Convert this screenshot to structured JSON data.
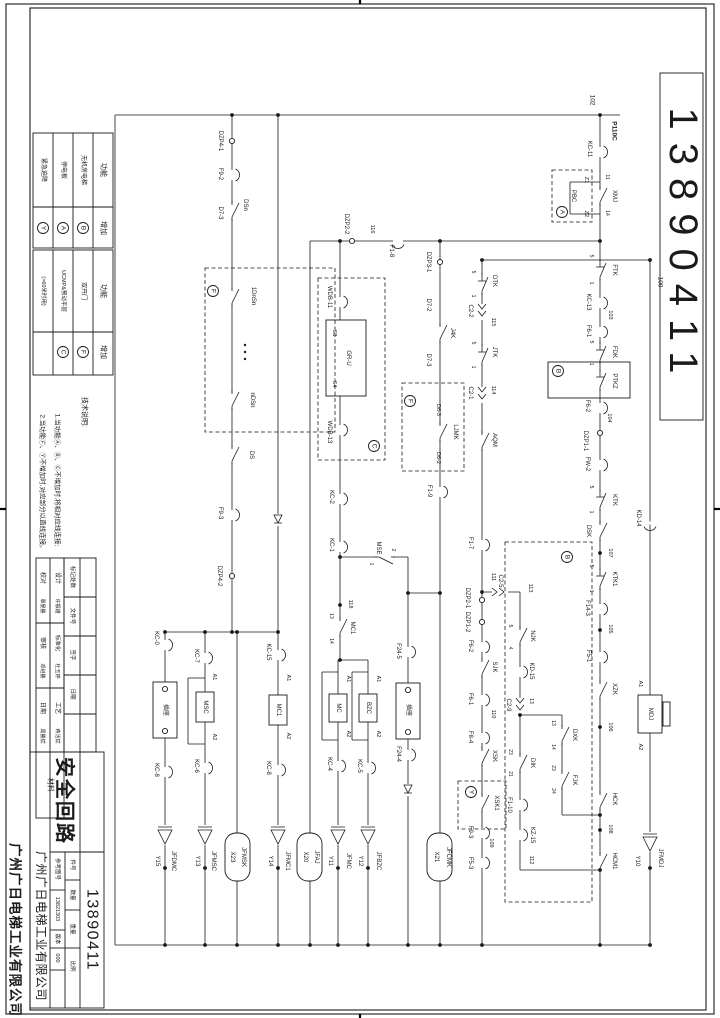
{
  "sheet": {
    "drawing_number": "13890411",
    "drawing_title": "安全回路",
    "company": "广州广日电梯工业有限公司",
    "reference_drawing_number": "13821303",
    "version": "000",
    "field_labels": {
      "reference": "参考图号",
      "part_no": "件号",
      "quantity": "数量",
      "weight": "重量",
      "scale": "比例",
      "version": "版本",
      "material": "材料"
    }
  },
  "function_tables": [
    {
      "headers": [
        "功能",
        "增加"
      ],
      "rows": [
        [
          "无机房电梯",
          "B"
        ],
        [
          "停电板",
          "A"
        ],
        [
          "紧急迫降",
          "Y"
        ]
      ]
    },
    {
      "headers": [
        "功能",
        "增加"
      ],
      "rows": [
        [
          "双开门",
          "F"
        ],
        [
          "UCMP&预动平层",
          "C"
        ],
        [
          "(>60米时用)",
          ""
        ]
      ]
    }
  ],
  "notes": {
    "title": "技术说明:",
    "lines": [
      "1.当功能Ⓐ、Ⓑ、Ⓒ不增加时,将相对应线连接;",
      "2.当功能Ⓕ、Ⓨ不增加时,对应部分以直线连接。"
    ]
  },
  "signatures": [
    {
      "role": "设计",
      "name": "许振雄"
    },
    {
      "role": "校对",
      "name": "覃晏勝"
    },
    {
      "role": "标准化",
      "name": "杜玉婷"
    },
    {
      "role": "审核",
      "name": "邓继勝"
    },
    {
      "role": "工艺",
      "name": "蒋活斌"
    },
    {
      "role": "日期",
      "name": "周勝斌"
    }
  ],
  "revision_table": {
    "headers": [
      "标记处数",
      "文件号",
      "签字",
      "日期"
    ]
  },
  "buses": {
    "top": "102",
    "feed": "P110C",
    "right": "100"
  },
  "labels": [
    {
      "t": "13890411",
      "x": 683,
      "y": 247,
      "s": 40,
      "ls": 13,
      "n": "drawing-number-top"
    },
    {
      "t": "功能",
      "x": 103,
      "y": 170,
      "s": 7
    },
    {
      "t": "增加",
      "x": 103,
      "y": 228,
      "s": 7
    },
    {
      "t": "无机房电梯",
      "x": 83,
      "y": 170,
      "s": 6
    },
    {
      "t": "停电板",
      "x": 63,
      "y": 170,
      "s": 6
    },
    {
      "t": "紧急迫降",
      "x": 43,
      "y": 170,
      "s": 6
    },
    {
      "t": "功能",
      "x": 103,
      "y": 291,
      "s": 7
    },
    {
      "t": "增加",
      "x": 103,
      "y": 352,
      "s": 7
    },
    {
      "t": "双开门",
      "x": 83,
      "y": 291,
      "s": 6
    },
    {
      "t": "UCMP&预动平层",
      "x": 63,
      "y": 291,
      "s": 5.5
    },
    {
      "t": "(>60米时用)",
      "x": 43,
      "y": 291,
      "s": 5.5
    },
    {
      "t": "技术说明:",
      "x": 84,
      "y": 412,
      "s": 7,
      "n": "notes-title"
    },
    {
      "t": "1.当功能Ⓐ、Ⓑ、Ⓒ不增加时,将相对应线连接;",
      "x": 57,
      "y": 480,
      "s": 6.5,
      "n": "note-line"
    },
    {
      "t": "2.当功能Ⓕ、Ⓨ不增加时,对应部分以直线连接。",
      "x": 42,
      "y": 483,
      "s": 6.5,
      "n": "note-line"
    },
    {
      "t": "校对",
      "x": 42,
      "y": 578,
      "s": 6
    },
    {
      "t": "覃晏勝",
      "x": 42,
      "y": 606,
      "s": 5
    },
    {
      "t": "设计",
      "x": 57,
      "y": 578,
      "s": 6
    },
    {
      "t": "许振雄",
      "x": 57,
      "y": 606,
      "s": 5
    },
    {
      "t": "审核",
      "x": 42,
      "y": 643,
      "s": 6
    },
    {
      "t": "邓继勝",
      "x": 42,
      "y": 671,
      "s": 5
    },
    {
      "t": "标准化",
      "x": 57,
      "y": 643,
      "s": 5.5
    },
    {
      "t": "杜玉婷",
      "x": 57,
      "y": 671,
      "s": 5
    },
    {
      "t": "日期",
      "x": 42,
      "y": 708,
      "s": 6
    },
    {
      "t": "周勝斌",
      "x": 42,
      "y": 736,
      "s": 5
    },
    {
      "t": "工艺",
      "x": 57,
      "y": 708,
      "s": 6
    },
    {
      "t": "蒋活斌",
      "x": 57,
      "y": 736,
      "s": 5
    },
    {
      "t": "材料",
      "x": 50,
      "y": 785,
      "s": 7
    },
    {
      "t": "标记处数",
      "x": 72,
      "y": 577,
      "s": 5.5
    },
    {
      "t": "文件号",
      "x": 72,
      "y": 616,
      "s": 5.5
    },
    {
      "t": "签字",
      "x": 72,
      "y": 655,
      "s": 5.5
    },
    {
      "t": "日期",
      "x": 72,
      "y": 694,
      "s": 5.5
    },
    {
      "t": "安全回路",
      "x": 64,
      "y": 801,
      "s": 20,
      "b": 1,
      "ls": 2,
      "n": "drawing-title"
    },
    {
      "t": "广州广日电梯工业有限公司",
      "x": 41,
      "y": 926,
      "s": 12,
      "ls": 0.5,
      "n": "company-name-small"
    },
    {
      "t": "广州广日电梯工业有限公司",
      "x": 15,
      "y": 930,
      "s": 13.5,
      "b": 1,
      "ls": 1,
      "n": "company-name-large"
    },
    {
      "t": "参考图号",
      "x": 57,
      "y": 869,
      "s": 5.5
    },
    {
      "t": "13821303",
      "x": 57,
      "y": 909,
      "s": 5.5,
      "n": "reference-number"
    },
    {
      "t": "版本",
      "x": 57,
      "y": 939,
      "s": 5.5
    },
    {
      "t": "000",
      "x": 57,
      "y": 958,
      "s": 5.5,
      "n": "version-value"
    },
    {
      "t": "件号",
      "x": 72,
      "y": 865,
      "s": 5.5
    },
    {
      "t": "数量",
      "x": 72,
      "y": 895,
      "s": 5.5
    },
    {
      "t": "重量",
      "x": 72,
      "y": 929,
      "s": 5.5
    },
    {
      "t": "比例",
      "x": 72,
      "y": 966,
      "s": 5.5
    },
    {
      "t": "13890411",
      "x": 92,
      "y": 930,
      "s": 16,
      "ls": 1.5,
      "n": "drawing-number-block"
    },
    {
      "t": "102",
      "x": 592,
      "y": 100,
      "s": 6.5,
      "n": "bus-label"
    },
    {
      "t": "P110C",
      "x": 614,
      "y": 131,
      "s": 6.5,
      "b": 1,
      "n": "bus-label"
    },
    {
      "t": "100",
      "x": 660,
      "y": 282,
      "s": 6.5,
      "n": "bus-label"
    },
    {
      "t": "KC-11",
      "x": 589,
      "y": 149
    },
    {
      "t": "XMJ",
      "x": 614,
      "y": 196
    },
    {
      "t": "11",
      "x": 607,
      "y": 177,
      "s": 5
    },
    {
      "t": "14",
      "x": 607,
      "y": 213,
      "s": 5
    },
    {
      "t": "Z1",
      "x": 586,
      "y": 180,
      "s": 5.5
    },
    {
      "t": "PBC",
      "x": 573,
      "y": 196
    },
    {
      "t": "Z2",
      "x": 586,
      "y": 214,
      "s": 5.5
    },
    {
      "t": "FTK",
      "x": 614,
      "y": 270
    },
    {
      "t": "5",
      "x": 591,
      "y": 256,
      "s": 5
    },
    {
      "t": "1",
      "x": 591,
      "y": 283,
      "s": 5
    },
    {
      "t": "KC-13",
      "x": 588,
      "y": 302
    },
    {
      "t": "103",
      "x": 610,
      "y": 315,
      "s": 5.5
    },
    {
      "t": "F6-1",
      "x": 588,
      "y": 331
    },
    {
      "t": "FDK",
      "x": 614,
      "y": 352
    },
    {
      "t": "5",
      "x": 591,
      "y": 342,
      "s": 5
    },
    {
      "t": "1",
      "x": 591,
      "y": 364,
      "s": 5
    },
    {
      "t": "PTKZ",
      "x": 614,
      "y": 381
    },
    {
      "t": "F6-2",
      "x": 587,
      "y": 406
    },
    {
      "t": "104",
      "x": 609,
      "y": 418,
      "s": 5.5
    },
    {
      "t": "DZP1-1",
      "x": 585,
      "y": 441
    },
    {
      "t": "FW-2",
      "x": 587,
      "y": 464
    },
    {
      "t": "KTK",
      "x": 614,
      "y": 500
    },
    {
      "t": "5",
      "x": 591,
      "y": 487,
      "s": 5
    },
    {
      "t": "1",
      "x": 591,
      "y": 512,
      "s": 5
    },
    {
      "t": "DSK",
      "x": 588,
      "y": 531
    },
    {
      "t": "107",
      "x": 610,
      "y": 553,
      "s": 5.5
    },
    {
      "t": "KTK1",
      "x": 614,
      "y": 579
    },
    {
      "t": "5",
      "x": 591,
      "y": 566,
      "s": 5
    },
    {
      "t": "1",
      "x": 591,
      "y": 591,
      "s": 5
    },
    {
      "t": "F14-3",
      "x": 587,
      "y": 608
    },
    {
      "t": "105",
      "x": 610,
      "y": 629,
      "s": 5.5
    },
    {
      "t": "F5-1",
      "x": 588,
      "y": 656
    },
    {
      "t": "XZK",
      "x": 614,
      "y": 689
    },
    {
      "t": "106",
      "x": 610,
      "y": 727,
      "s": 5.5
    },
    {
      "t": "HCK",
      "x": 614,
      "y": 799
    },
    {
      "t": "108",
      "x": 610,
      "y": 829,
      "s": 5.5
    },
    {
      "t": "HCM1",
      "x": 614,
      "y": 861
    },
    {
      "t": "KD-14",
      "x": 638,
      "y": 518
    },
    {
      "t": "A1",
      "x": 640,
      "y": 684,
      "s": 5.5
    },
    {
      "t": "MDJ",
      "x": 650,
      "y": 714
    },
    {
      "t": "A2",
      "x": 640,
      "y": 747,
      "s": 5.5
    },
    {
      "t": "Y10",
      "x": 637,
      "y": 861
    },
    {
      "t": "JFMDJ",
      "x": 660,
      "y": 858
    },
    {
      "t": "DZP4-1",
      "x": 220,
      "y": 141
    },
    {
      "t": "F9-2",
      "x": 220,
      "y": 174
    },
    {
      "t": "DSn",
      "x": 245,
      "y": 205
    },
    {
      "t": "D7-3",
      "x": 220,
      "y": 213
    },
    {
      "t": "1DnSn",
      "x": 253,
      "y": 296
    },
    {
      "t": "nDSn",
      "x": 252,
      "y": 400
    },
    {
      "t": "DS",
      "x": 251,
      "y": 455
    },
    {
      "t": "F9-3",
      "x": 220,
      "y": 513
    },
    {
      "t": "DZP4-2",
      "x": 219,
      "y": 576
    },
    {
      "t": "KC-0",
      "x": 156,
      "y": 638
    },
    {
      "t": "KC-8",
      "x": 156,
      "y": 770
    },
    {
      "t": "插座",
      "x": 165,
      "y": 710,
      "s": 6
    },
    {
      "t": "Y15",
      "x": 157,
      "y": 861
    },
    {
      "t": "JFDMC",
      "x": 173,
      "y": 861
    },
    {
      "t": "KC-7",
      "x": 196,
      "y": 656
    },
    {
      "t": "A1",
      "x": 214,
      "y": 677,
      "s": 5.5
    },
    {
      "t": "MSC",
      "x": 205,
      "y": 707
    },
    {
      "t": "A2",
      "x": 214,
      "y": 737,
      "s": 5.5
    },
    {
      "t": "KC-6",
      "x": 196,
      "y": 766
    },
    {
      "t": "Y13",
      "x": 197,
      "y": 861
    },
    {
      "t": "JFMSC",
      "x": 213,
      "y": 861
    },
    {
      "t": "X23",
      "x": 232,
      "y": 857
    },
    {
      "t": "JFMSK",
      "x": 243,
      "y": 857
    },
    {
      "t": "KC-15",
      "x": 268,
      "y": 652
    },
    {
      "t": "A1",
      "x": 288,
      "y": 678,
      "s": 5.5
    },
    {
      "t": "MC1",
      "x": 278,
      "y": 710
    },
    {
      "t": "A2",
      "x": 288,
      "y": 736,
      "s": 5.5
    },
    {
      "t": "KC-8",
      "x": 268,
      "y": 768
    },
    {
      "t": "Y14",
      "x": 270,
      "y": 861
    },
    {
      "t": "JFMC1",
      "x": 287,
      "y": 861
    },
    {
      "t": "X20",
      "x": 305,
      "y": 857
    },
    {
      "t": "JFAJ",
      "x": 316,
      "y": 857
    },
    {
      "t": "DZP2-2",
      "x": 346,
      "y": 224
    },
    {
      "t": "116",
      "x": 372,
      "y": 229,
      "s": 5.5
    },
    {
      "t": "F1-8",
      "x": 391,
      "y": 251
    },
    {
      "t": "WDB-11",
      "x": 329,
      "y": 297
    },
    {
      "t": "S3",
      "x": 334,
      "y": 333,
      "s": 5.5
    },
    {
      "t": "GR-U",
      "x": 348,
      "y": 358
    },
    {
      "t": "S4",
      "x": 334,
      "y": 384,
      "s": 5.5
    },
    {
      "t": "WDB-13",
      "x": 329,
      "y": 432
    },
    {
      "t": "KC-2",
      "x": 331,
      "y": 497
    },
    {
      "t": "KC-1",
      "x": 331,
      "y": 545
    },
    {
      "t": "MSE",
      "x": 378,
      "y": 548
    },
    {
      "t": "2",
      "x": 393,
      "y": 550,
      "s": 5
    },
    {
      "t": "1",
      "x": 371,
      "y": 564,
      "s": 5
    },
    {
      "t": "118",
      "x": 350,
      "y": 604,
      "s": 5.5
    },
    {
      "t": "13",
      "x": 331,
      "y": 616,
      "s": 5
    },
    {
      "t": "MC1",
      "x": 352,
      "y": 628
    },
    {
      "t": "14",
      "x": 331,
      "y": 641,
      "s": 5
    },
    {
      "t": "A1",
      "x": 348,
      "y": 679,
      "s": 5.5
    },
    {
      "t": "MC",
      "x": 338,
      "y": 708
    },
    {
      "t": "A2",
      "x": 348,
      "y": 734,
      "s": 5.5
    },
    {
      "t": "KC-4",
      "x": 329,
      "y": 764
    },
    {
      "t": "Y11",
      "x": 330,
      "y": 861
    },
    {
      "t": "JFMC",
      "x": 348,
      "y": 861
    },
    {
      "t": "A1",
      "x": 378,
      "y": 679,
      "s": 5.5
    },
    {
      "t": "BZC",
      "x": 368,
      "y": 708
    },
    {
      "t": "A2",
      "x": 378,
      "y": 734,
      "s": 5.5
    },
    {
      "t": "KC-5",
      "x": 359,
      "y": 766
    },
    {
      "t": "Y12",
      "x": 360,
      "y": 861
    },
    {
      "t": "JFBZC",
      "x": 378,
      "y": 861
    },
    {
      "t": "F24-5",
      "x": 398,
      "y": 651
    },
    {
      "t": "插座",
      "x": 408,
      "y": 710,
      "s": 6
    },
    {
      "t": "F24-4",
      "x": 398,
      "y": 754
    },
    {
      "t": "DZP3-1",
      "x": 428,
      "y": 262
    },
    {
      "t": "D7-2",
      "x": 428,
      "y": 305
    },
    {
      "t": "J4K",
      "x": 452,
      "y": 333
    },
    {
      "t": "D7-3",
      "x": 428,
      "y": 360
    },
    {
      "t": "D6-3",
      "x": 438,
      "y": 410,
      "s": 5.5
    },
    {
      "t": "LJMK",
      "x": 455,
      "y": 432
    },
    {
      "t": "D6-2",
      "x": 438,
      "y": 458,
      "s": 5.5
    },
    {
      "t": "F1-9",
      "x": 429,
      "y": 491
    },
    {
      "t": "X21",
      "x": 436,
      "y": 857
    },
    {
      "t": "JFCMK",
      "x": 448,
      "y": 857
    },
    {
      "t": "DTK",
      "x": 494,
      "y": 281
    },
    {
      "t": "5",
      "x": 473,
      "y": 272,
      "s": 5
    },
    {
      "t": "1",
      "x": 473,
      "y": 296,
      "s": 5
    },
    {
      "t": "C2-2",
      "x": 470,
      "y": 311
    },
    {
      "t": "115",
      "x": 493,
      "y": 322,
      "s": 5.5
    },
    {
      "t": "JTK",
      "x": 494,
      "y": 352
    },
    {
      "t": "5",
      "x": 473,
      "y": 343,
      "s": 5
    },
    {
      "t": "1",
      "x": 473,
      "y": 367,
      "s": 5
    },
    {
      "t": "C2-1",
      "x": 470,
      "y": 393
    },
    {
      "t": "114",
      "x": 493,
      "y": 390,
      "s": 5.5
    },
    {
      "t": "AQM",
      "x": 494,
      "y": 440
    },
    {
      "t": "F1-7",
      "x": 470,
      "y": 543
    },
    {
      "t": "111",
      "x": 493,
      "y": 577,
      "s": 5.5
    },
    {
      "t": "DZP2-1",
      "x": 467,
      "y": 598
    },
    {
      "t": "DZP1-2",
      "x": 467,
      "y": 622
    },
    {
      "t": "F6-2",
      "x": 470,
      "y": 646
    },
    {
      "t": "SJK",
      "x": 494,
      "y": 667
    },
    {
      "t": "F6-1",
      "x": 470,
      "y": 699
    },
    {
      "t": "110",
      "x": 493,
      "y": 714,
      "s": 5.5
    },
    {
      "t": "F8-4",
      "x": 470,
      "y": 737
    },
    {
      "t": "XSK",
      "x": 494,
      "y": 756
    },
    {
      "t": "XSK1",
      "x": 496,
      "y": 803
    },
    {
      "t": "F9-3",
      "x": 470,
      "y": 832
    },
    {
      "t": "109",
      "x": 491,
      "y": 843,
      "s": 5.5
    },
    {
      "t": "F5-3",
      "x": 470,
      "y": 863
    },
    {
      "t": "C2-5",
      "x": 500,
      "y": 581
    },
    {
      "t": "113",
      "x": 530,
      "y": 588,
      "s": 5.5
    },
    {
      "t": "5",
      "x": 510,
      "y": 626,
      "s": 5
    },
    {
      "t": "NJK",
      "x": 532,
      "y": 636
    },
    {
      "t": "4",
      "x": 510,
      "y": 648,
      "s": 5
    },
    {
      "t": "KD-15",
      "x": 531,
      "y": 671
    },
    {
      "t": "C2-9",
      "x": 508,
      "y": 705
    },
    {
      "t": "13",
      "x": 531,
      "y": 701,
      "s": 5
    },
    {
      "t": "23",
      "x": 510,
      "y": 752,
      "s": 5
    },
    {
      "t": "DIK",
      "x": 532,
      "y": 763
    },
    {
      "t": "21",
      "x": 510,
      "y": 774,
      "s": 5
    },
    {
      "t": "F1-10",
      "x": 509,
      "y": 805
    },
    {
      "t": "KZ-15",
      "x": 532,
      "y": 835
    },
    {
      "t": "112",
      "x": 531,
      "y": 860,
      "s": 5.5
    },
    {
      "t": "13",
      "x": 553,
      "y": 723,
      "s": 5
    },
    {
      "t": "DXK",
      "x": 574,
      "y": 735
    },
    {
      "t": "14",
      "x": 553,
      "y": 747,
      "s": 5
    },
    {
      "t": "23",
      "x": 553,
      "y": 768,
      "s": 5
    },
    {
      "t": "FJK",
      "x": 574,
      "y": 780
    },
    {
      "t": "24",
      "x": 553,
      "y": 791,
      "s": 5
    }
  ],
  "circles": [
    {
      "l": "B",
      "x": 83,
      "y": 228
    },
    {
      "l": "A",
      "x": 63,
      "y": 228
    },
    {
      "l": "Y",
      "x": 43,
      "y": 228
    },
    {
      "l": "F",
      "x": 83,
      "y": 352
    },
    {
      "l": "C",
      "x": 63,
      "y": 352
    },
    {
      "l": "A",
      "x": 562,
      "y": 212
    },
    {
      "l": "B",
      "x": 558,
      "y": 371
    },
    {
      "l": "B",
      "x": 567,
      "y": 557
    },
    {
      "l": "C",
      "x": 374,
      "y": 446
    },
    {
      "l": "F",
      "x": 213,
      "y": 291
    },
    {
      "l": "F",
      "x": 410,
      "y": 401
    },
    {
      "l": "Y",
      "x": 471,
      "y": 792
    }
  ]
}
